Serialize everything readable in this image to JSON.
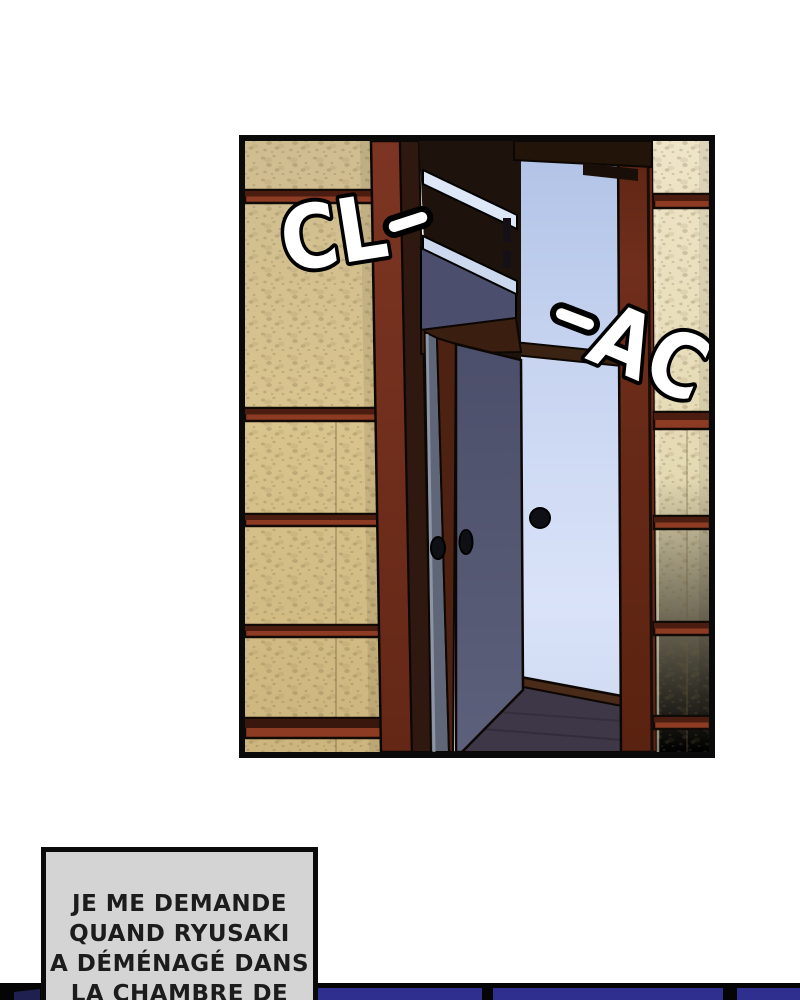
{
  "panel": {
    "sfx": [
      {
        "text": "CL-",
        "letters": "CL"
      },
      {
        "text": "-AC",
        "letters": "AC"
      }
    ],
    "colors": {
      "outline": "#0a0a0a",
      "wall_tan_left": "#d6c28f",
      "wall_tan_right": "#e8dfbd",
      "frame_maroon": "#7c3421",
      "door_navy": "#53566f",
      "door_slate": "#5f6678",
      "doorway_light_blue": "#c9d6f2",
      "floor_dark": "#3e3748",
      "sfx_fill": "#ffffff"
    }
  },
  "caption": {
    "lines": [
      "JE ME DEMANDE",
      "QUAND RYUSAKI",
      "A DÉMÉNAGÉ DANS",
      "LA CHAMBRE DE"
    ],
    "background": "#d4d4d4",
    "text_color": "#1c1c1c"
  },
  "next_panel": {
    "background": "#050505",
    "panel_blue": "#2e2f8e"
  }
}
